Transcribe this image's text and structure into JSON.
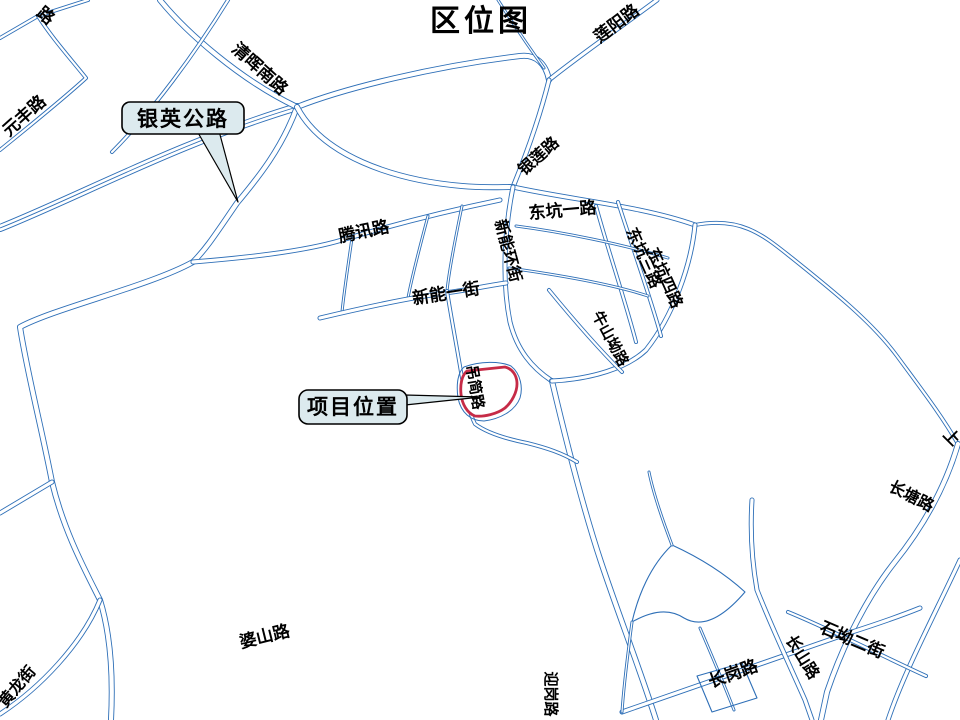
{
  "title": "区位图",
  "colors": {
    "background": "#ffffff",
    "road_line": "#2e6fb7",
    "site_outline": "#c62b47",
    "callout_fill": "#dceaee",
    "callout_border": "#000000",
    "label_text": "#000000"
  },
  "callouts": {
    "yinying": "银英公路",
    "project": "项目位置"
  },
  "labels": {
    "partial_top_left": "路",
    "lianyang": "莲阳路",
    "qinghui": "清晖南路",
    "yuanfeng": "元丰路",
    "yinlian": "银莲路",
    "dongkeng1": "东坑一路",
    "tengxun": "腾讯路",
    "xinnenghuan": "新能环街",
    "xinneng1": "新能一街",
    "dongkeng3": "东坑三路",
    "dongkeng4": "东坑四路",
    "niushanao": "牛山坳路",
    "diaojian": "吊简路",
    "partial_right": "上",
    "changtang": "长塘路",
    "poshan": "婆山路",
    "huanglong": "黄龙街",
    "yinggang": "迎岗路",
    "changgang": "长岗路",
    "changshan": "长山路",
    "shiao2": "石坳二街"
  }
}
